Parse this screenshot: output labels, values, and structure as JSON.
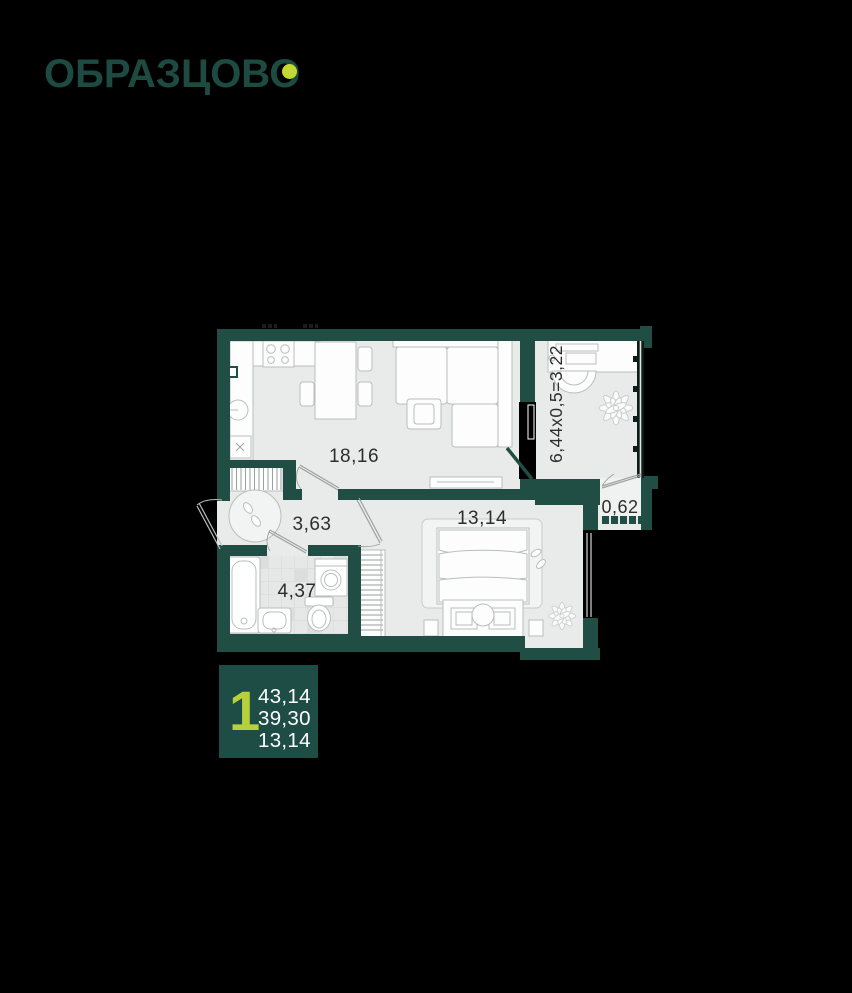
{
  "logo": {
    "brand": "ОБРАЗЦОВО"
  },
  "plan": {
    "rooms": [
      {
        "id": "kitchen-living",
        "label": "18,16"
      },
      {
        "id": "hallway",
        "label": "3,63"
      },
      {
        "id": "bathroom",
        "label": "4,37"
      },
      {
        "id": "bedroom",
        "label": "13,14"
      },
      {
        "id": "loggia-part",
        "label": "0,62"
      },
      {
        "id": "loggia-formula",
        "label": "6,44x0,5=3,22"
      }
    ]
  },
  "info_card": {
    "rooms_count": "1",
    "total_area": "43,14",
    "living_area": "39,30",
    "room_area": "13,14"
  },
  "colors": {
    "background": "#000000",
    "wall": "#204D44",
    "accent": "#C3D832",
    "floor": "#E9EBEA",
    "card": "#1E4D45"
  }
}
